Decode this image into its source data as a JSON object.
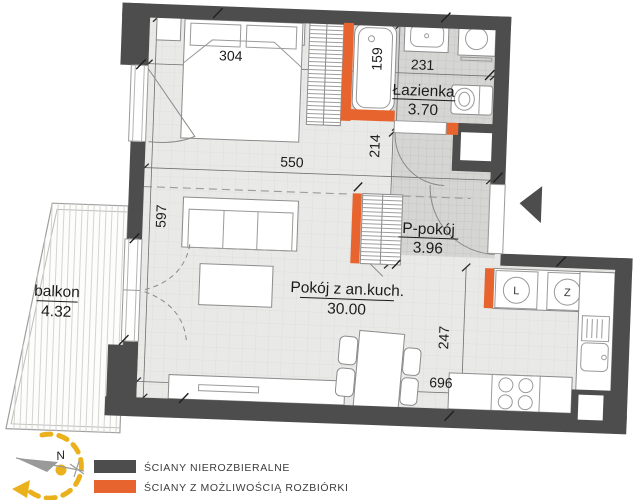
{
  "rooms": {
    "balcony": {
      "name": "balkon",
      "area": "4.32"
    },
    "bathroom": {
      "name": "Łazienka",
      "area": "3.70"
    },
    "hallway": {
      "name": "P-pokój",
      "area": "3.96"
    },
    "living_kitchen": {
      "name": "Pokój z an.kuch.",
      "area": "30.00"
    }
  },
  "dimensions": {
    "bedroom_width": "304",
    "bathroom_width": "231",
    "bathtub_length": "159",
    "living_width": "550",
    "hallway_length": "214",
    "living_length": "597",
    "kitchen_depth": "247",
    "bottom_width": "696"
  },
  "appliances": {
    "fridge": "L",
    "dishwasher": "Z"
  },
  "compass": {
    "north": "N"
  },
  "legend": [
    {
      "label": "ŚCIANY NIEROZBIERALNE",
      "color": "#4d4d4d"
    },
    {
      "label": "ŚCIANY Z MOŻLIWOŚCIĄ ROZBIÓRKI",
      "color": "#e7642e"
    }
  ],
  "colors": {
    "fixed_wall": "#4d4d4d",
    "removable_wall": "#e7642e",
    "floor": "#e9e9e7",
    "wet_floor": "#d5d5d3",
    "compass_accent": "#eab11c"
  }
}
